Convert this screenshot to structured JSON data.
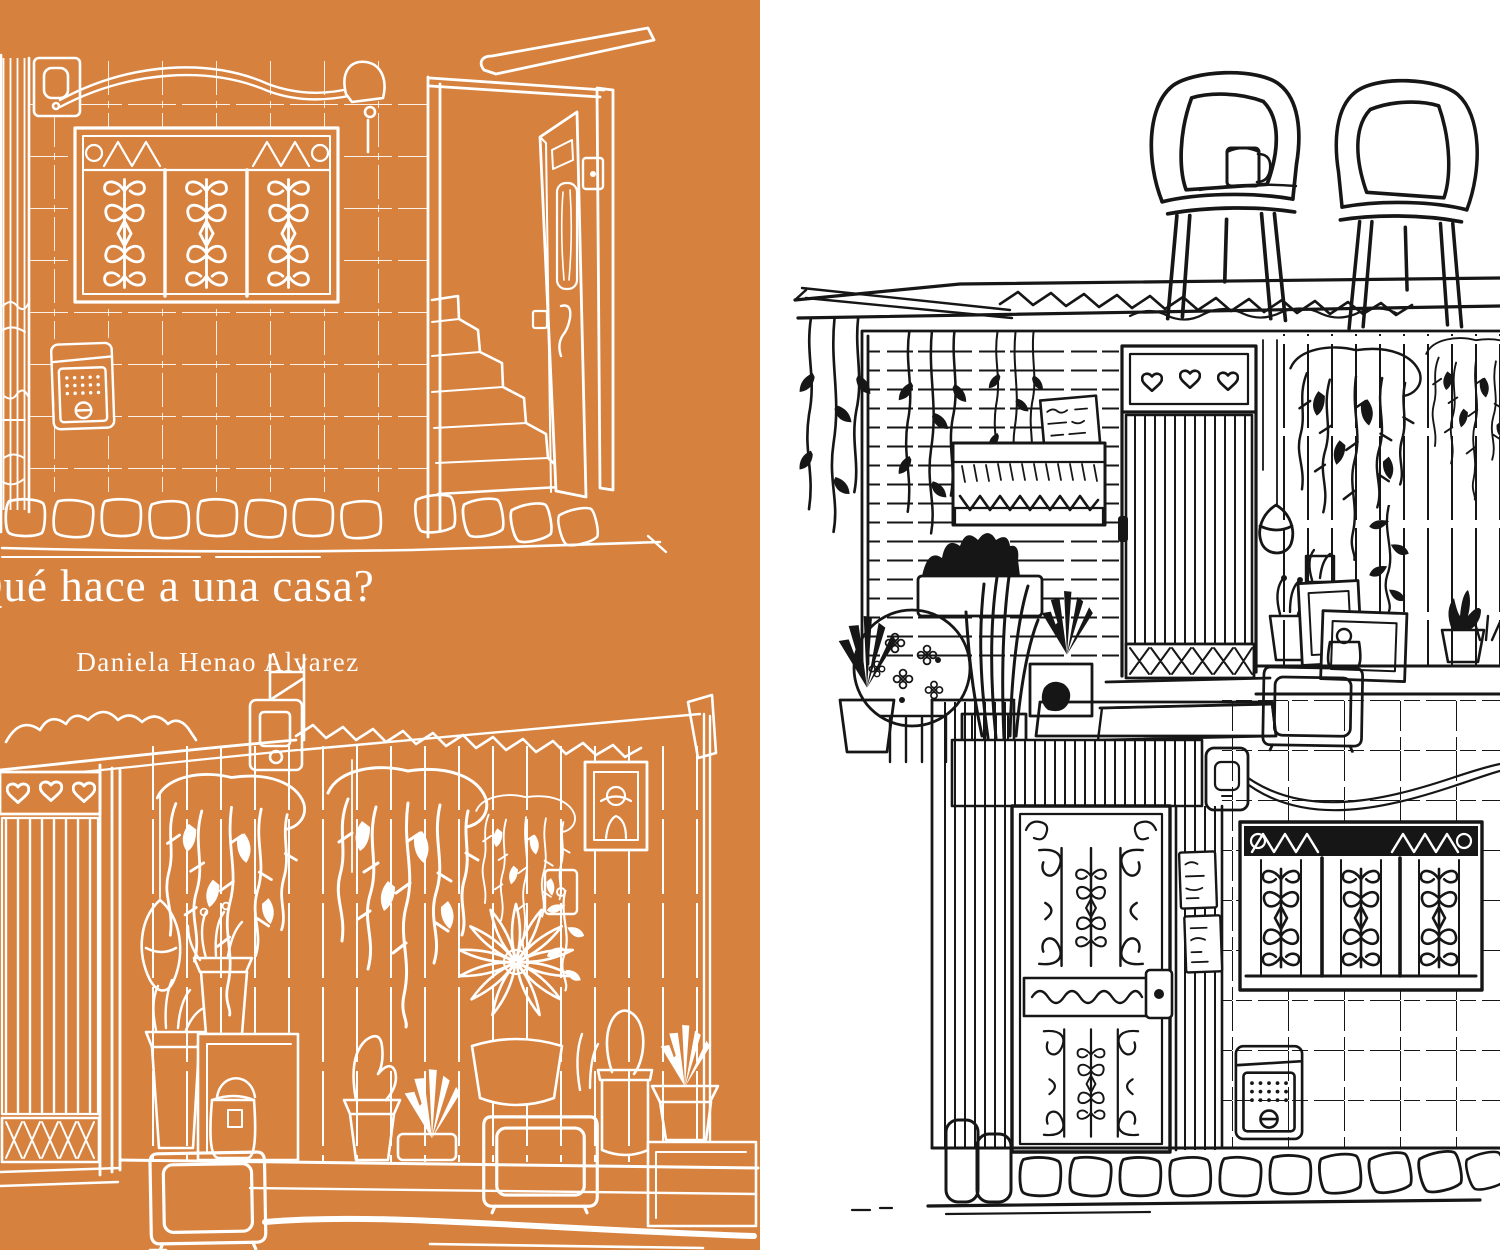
{
  "page": {
    "width": 1500,
    "height": 1250
  },
  "colors": {
    "cover_orange": "#d6813e",
    "art_white": "#ffffff",
    "art_black": "#161616",
    "paper": "#ffffff"
  },
  "cover": {
    "title": "Qué hace a una casa?",
    "author": "Daniela Henao Alvarez"
  },
  "panels": {
    "left": {
      "label": "orange cover panel with white line art"
    },
    "right": {
      "label": "white panel with black line art"
    }
  },
  "artwork": {
    "tile_house": "tiled house facade with ornate window grille, open door and stairs",
    "plant_house": "wood-plank house facade with hanging plants, potted plants and TV sets",
    "stacked_house": "two-story house with two plastic chairs and a mug on the rooftop"
  }
}
